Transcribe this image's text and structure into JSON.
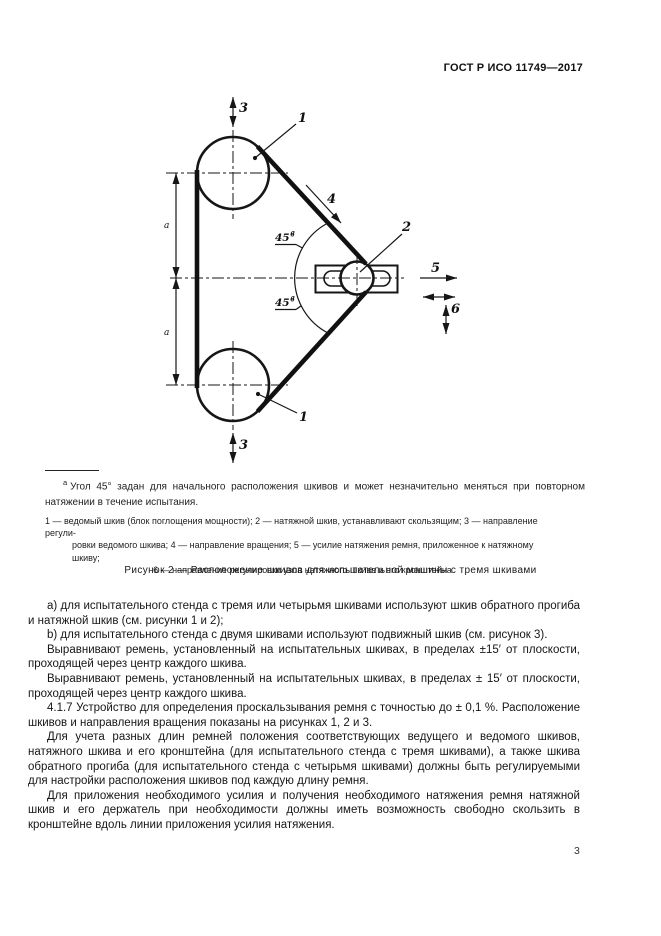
{
  "page": {
    "header": "ГОСТ Р ИСО 11749—2017",
    "page_number": "3",
    "colors": {
      "ink": "#1c1c1c",
      "paper": "#ffffff"
    }
  },
  "figure": {
    "labels": {
      "driven_pulley": "1",
      "tension_pulley": "2",
      "adjust_driven": "3",
      "rotation": "4",
      "tension_force": "5",
      "adjust_tension_unit": "6",
      "angle": "45°",
      "angle_footnote": "a",
      "span": "a"
    },
    "footnote": {
      "marker": "a",
      "text": "Угол 45° задан для начального расположения шкивов и может незначительно меняться при повторном натяжении в течение испытания."
    },
    "legend_lines": [
      "1 — ведомый шкив (блок поглощения мощности); 2 — натяжной шкив, устанавливают скользящим; 3 — направление регули-",
      "ровки ведомого шкива; 4 — направление вращения; 5 — усилие натяжения ремня, приложенное к натяжному шкиву;",
      "6 — направление регулировки узла натяжного шкива и его кронштейна"
    ],
    "caption": "Рисунок 2 — Расположение шкивов для испытательной машины с тремя шкивами"
  },
  "body": {
    "paragraphs": [
      "a) для испытательного стенда с тремя или четырьмя шкивами используют шкив обратного прогиба и натяжной шкив (см. рисунки 1 и 2);",
      "b) для испытательного стенда с двумя шкивами используют подвижный шкив (см. рисунок 3).",
      "Выравнивают ремень, установленный на испытательных шкивах, в пределах ±15′ от плоскости, проходящей через центр каждого шкива.",
      "Выравнивают ремень, установленный на испытательных шкивах, в пределах ± 15′ от плоскости, проходящей через центр каждого шкива.",
      "4.1.7 Устройство для определения проскальзывания ремня с точностью до ± 0,1 %. Расположение шкивов и направления вращения показаны на рисунках 1, 2 и 3.",
      "Для учета разных длин ремней положения соответствующих ведущего и ведомого шкивов, натяжного шкива и его кронштейна (для испытательного стенда с тремя шкивами), а также шкива обратного прогиба (для испытательного стенда с четырьмя шкивами) должны быть регулируемыми для настройки расположения шкивов под каждую длину ремня.",
      "Для приложения необходимого усилия и получения необходимого натяжения ремня натяжной шкив и его держатель при необходимости должны иметь возможность свободно скользить в кронштейне вдоль линии приложения усилия натяжения."
    ]
  }
}
